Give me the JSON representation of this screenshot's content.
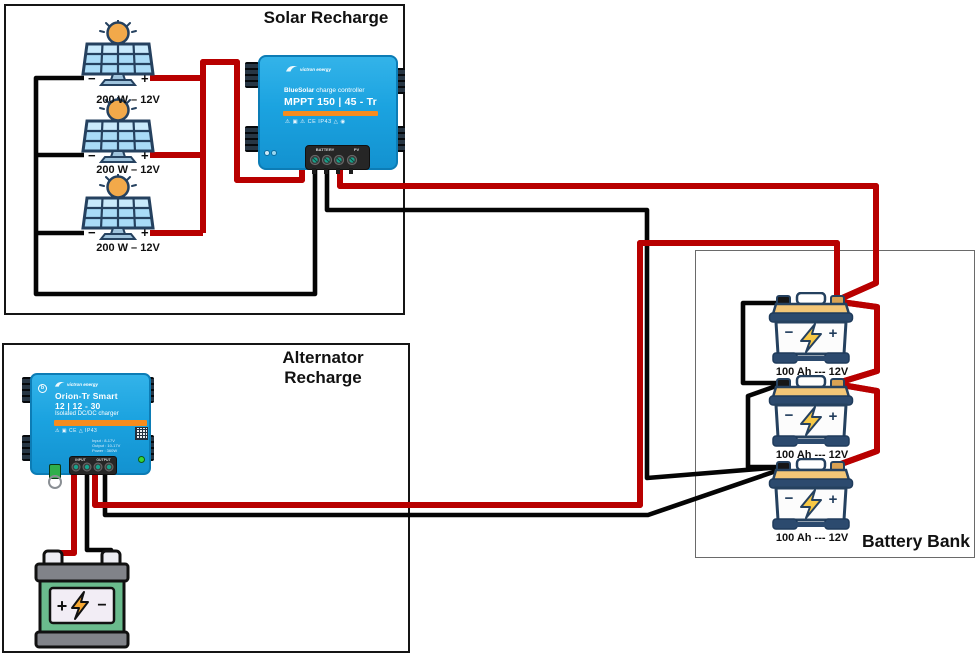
{
  "diagram": {
    "signs": {
      "plus": "+",
      "minus": "−"
    },
    "solar": {
      "title": "Solar Recharge",
      "panels": [
        {
          "label": "200 W – 12V"
        },
        {
          "label": "200 W – 12V"
        },
        {
          "label": "200 W – 12V"
        }
      ],
      "controller": {
        "brand": "victron energy",
        "product": "BlueSolar",
        "product_suffix": " charge controller",
        "model": "MPPT 150 | 45 - Tr",
        "certifications": "⚠ ▣ ⚠ CE IP43 △ ◉",
        "terminals": {
          "battery": "BATTERY",
          "pv": "PV"
        }
      }
    },
    "alternator": {
      "title": "Alternator Recharge",
      "charger": {
        "brand": "victron energy",
        "name": "Orion-Tr Smart",
        "model": "12 | 12 - 30",
        "subtitle": "Isolated DC/DC charger",
        "certifications": "⚠ ▣ CE △ IP43",
        "specs": [
          "Input : 8-17V",
          "Output : 10-17V",
          "Power : 360W"
        ],
        "terminals": {
          "input": "INPUT",
          "output": "OUTPUT"
        }
      }
    },
    "battery_bank": {
      "title": "Battery Bank",
      "batteries": [
        {
          "label": "100 Ah --- 12V"
        },
        {
          "label": "100 Ah --- 12V"
        },
        {
          "label": "100 Ah --- 12V"
        }
      ]
    },
    "colors": {
      "wire_red": "#f81414",
      "wire_black": "#050505",
      "victron_blue": "#1ba3e0",
      "victron_orange": "#f68c1e"
    }
  }
}
